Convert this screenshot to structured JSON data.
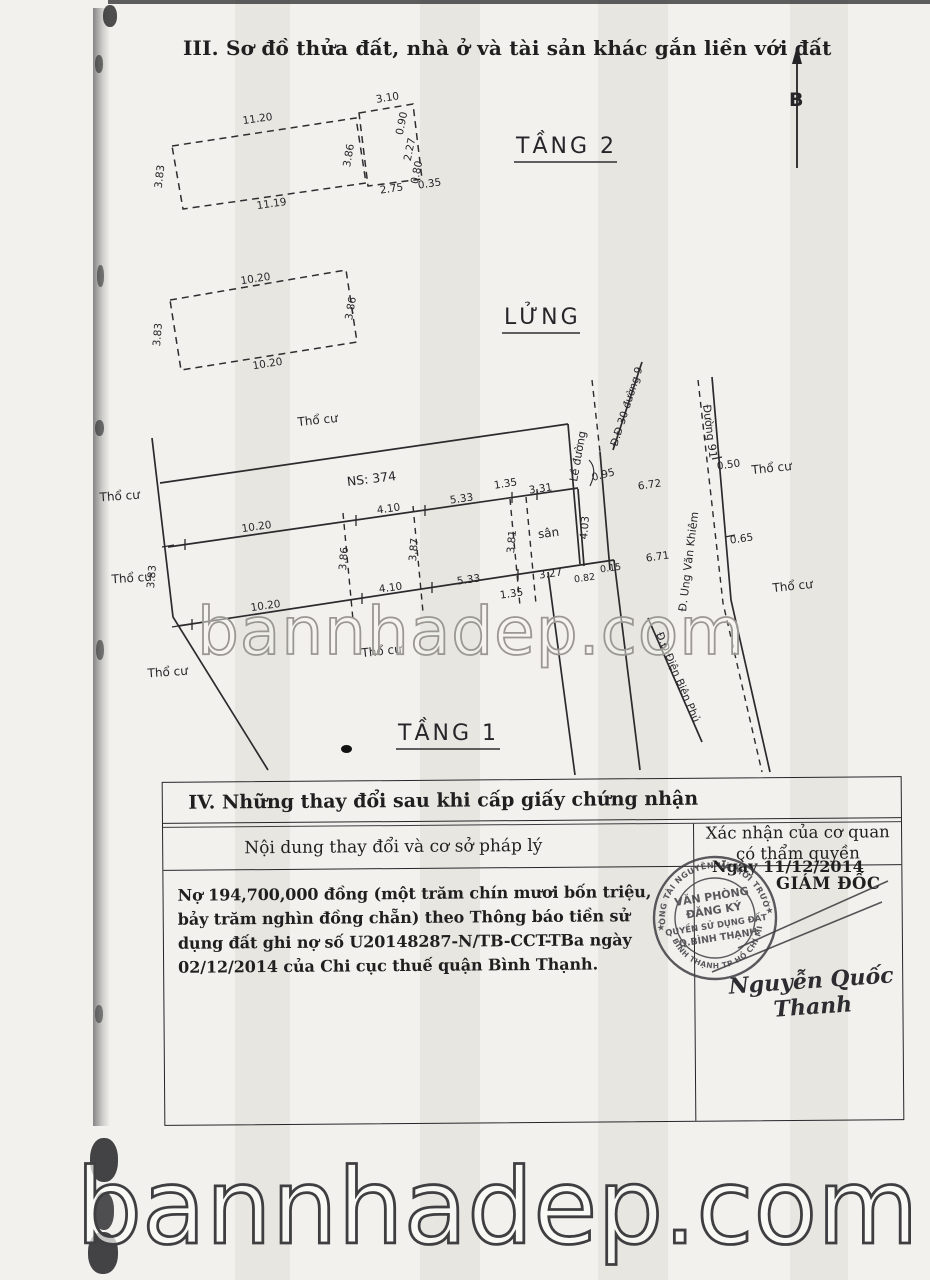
{
  "scan": {
    "watermark_mid": "bannhadep.com",
    "watermark_bottom": "bannhadep.com"
  },
  "section3": {
    "title": "III. Sơ đồ thửa đất, nhà ở và tài sản khác gắn liền với đất",
    "north": "B",
    "floor2": {
      "label": "TẦNG 2",
      "d_top": "11.20",
      "d_bottom": "11.19",
      "d_left": "3.83",
      "d_right": "3.86",
      "ext_top": "3.10",
      "ext_s1": "0.90",
      "ext_s2": "2.27",
      "ext_s3": "0.80",
      "ext_bottom": "2.75",
      "ext_off": "0.35"
    },
    "mezz": {
      "label": "LỬNG",
      "d_top": "10.20",
      "d_bottom": "10.20",
      "d_left": "3.83",
      "d_right": "3.86"
    },
    "floor1": {
      "label": "TẦNG 1",
      "ns": "NS: 374",
      "yard": "sân",
      "tho_cu": "Thổ cư",
      "dim_top_1": "10.20",
      "dim_top_2": "4.10",
      "dim_top_3": "5.33",
      "dim_top_4": "1.35",
      "dim_top_5": "3.31",
      "dim_bot_1": "10.20",
      "dim_bot_2": "4.10",
      "dim_bot_3": "5.33",
      "dim_bot_4": "1.35",
      "dim_bot_5": "3.27",
      "dim_bot_6": "0.82",
      "dim_bot_7": "0.15",
      "dim_left": "3.83",
      "dim_part_1": "3.86",
      "dim_part_2": "3.87",
      "dim_part_3": "3.81",
      "dim_part_4": "4.03",
      "dim_road_1": "0.95",
      "dim_road_2": "0.50",
      "dim_road_3": "0.65",
      "dim_road_4": "6.72",
      "dim_road_5": "6.71",
      "road_le_duong": "Lề đường",
      "road_duong91": "Đường 91",
      "road_d30": "Đ.Đ 30 đường 9",
      "road_uvk": "Đ. Ung Văn Khiêm",
      "road_dbp": "Đ.Đ Điện Biên Phủ"
    }
  },
  "section4": {
    "title": "IV. Những thay đổi sau khi cấp giấy chứng nhận",
    "col_left": "Nội dung thay đổi và cơ sở pháp lý",
    "col_right": "Xác nhận của cơ quan có thẩm quyền",
    "entry": "Nợ 194,700,000 đồng (một trăm chín mươi bốn triệu, bảy trăm nghìn đồng chẵn) theo Thông báo tiền sử dụng đất ghi nợ số U20148287-N/TB-CCT-TBa ngày 02/12/2014 của Chi cục thuế quận Bình Thạnh.",
    "date": "Ngày 11/12/2014",
    "director": "GIÁM ĐỐC",
    "signature": "Nguyễn Quốc Thanh",
    "stamp": {
      "line1": "VĂN PHÒNG",
      "line2": "ĐĂNG KÝ",
      "line3": "QUYỀN SỬ DỤNG ĐẤT",
      "line4": "Q.BÌNH THẠNH",
      "ring_top": "PHÒNG TÀI NGUYÊN VÀ MÔI TRƯỜNG",
      "ring_bottom": "Q. BÌNH THẠNH TP HỒ CHÍ MINH",
      "star": "★"
    }
  },
  "colors": {
    "ink": "#1f1f1f",
    "stamp": "#3e3e44",
    "watermark": "#8f8d89"
  }
}
